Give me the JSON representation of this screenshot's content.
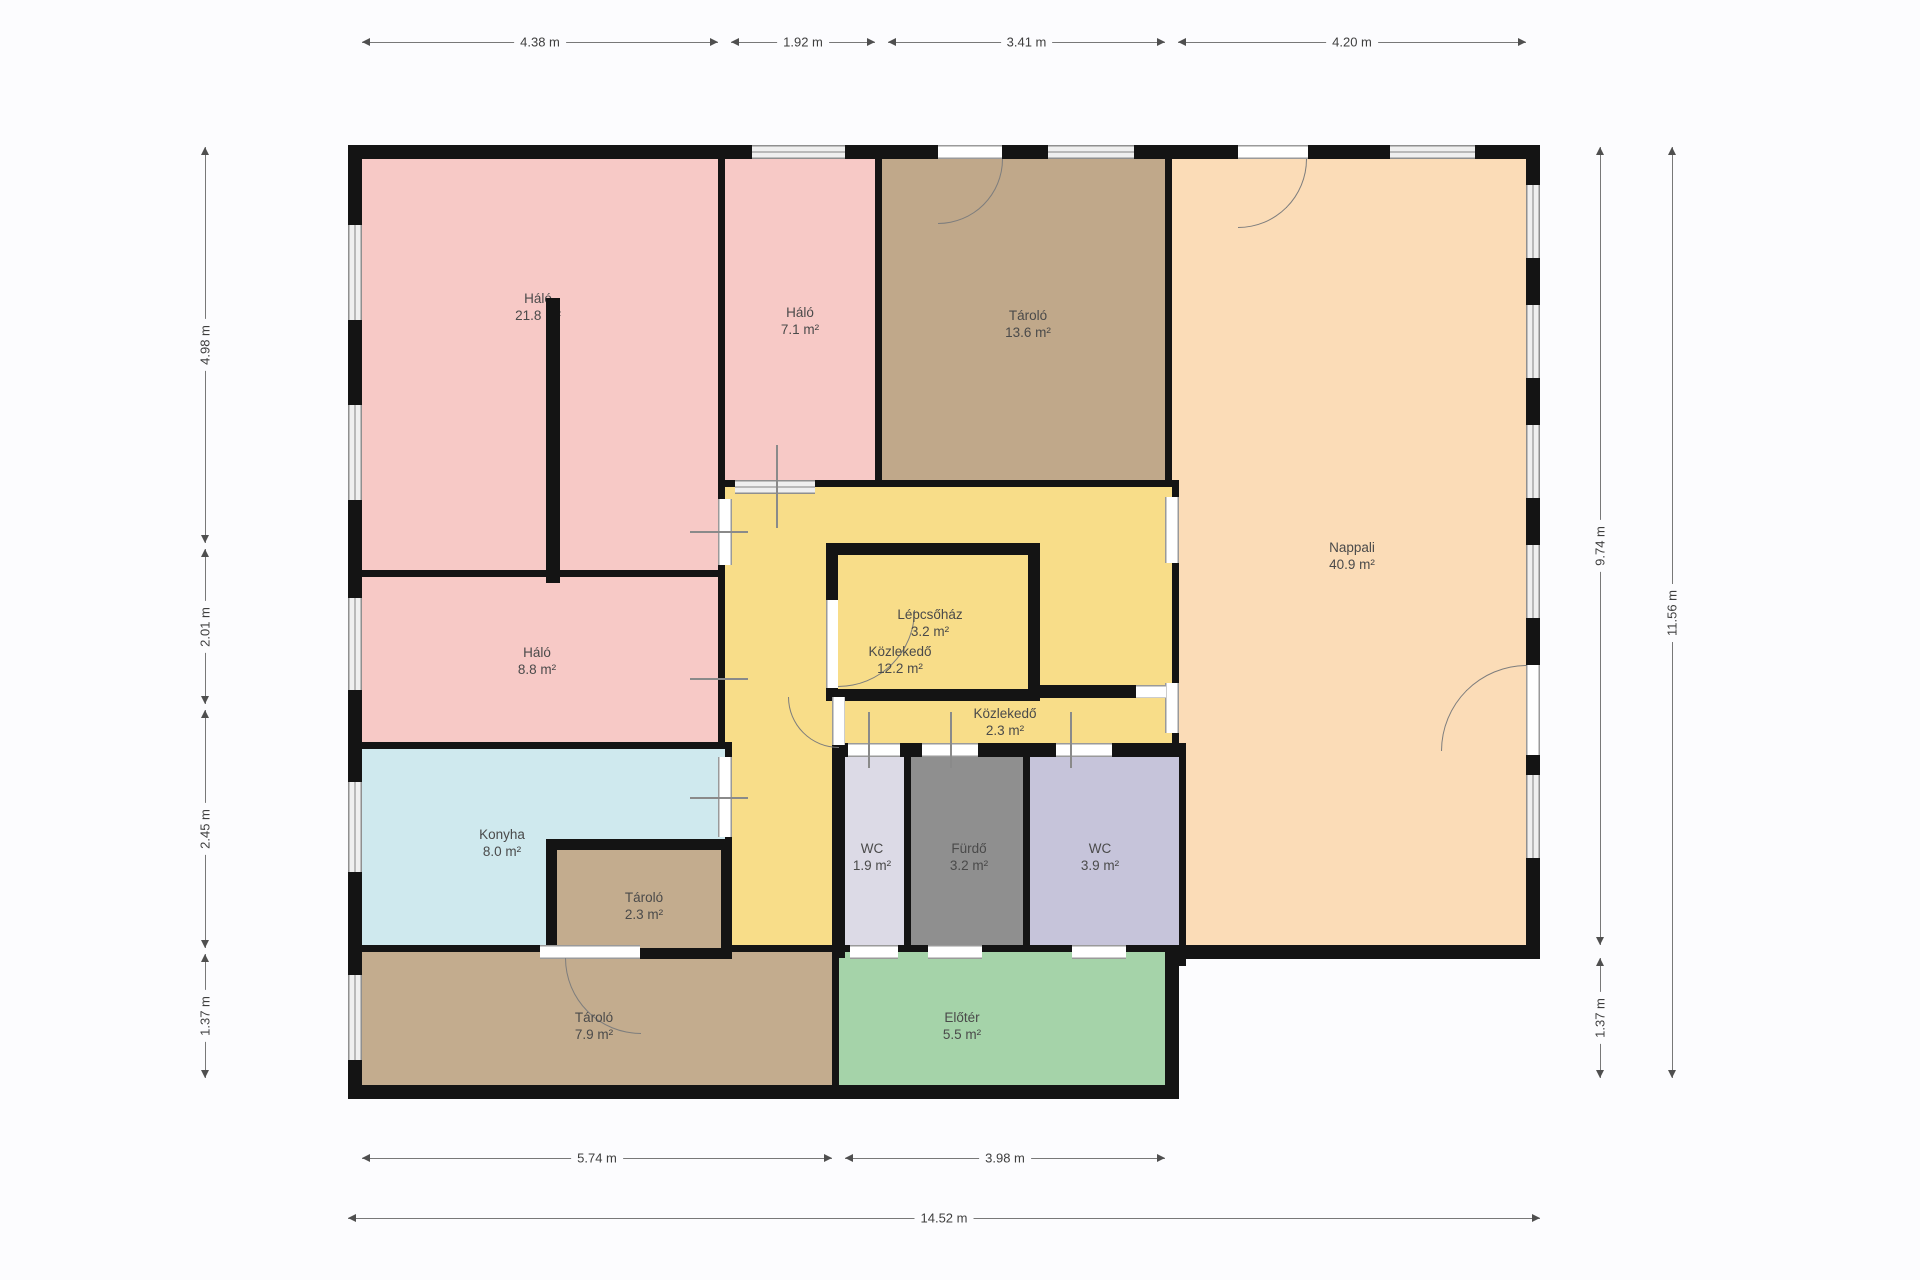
{
  "plan": {
    "title": "Floor plan",
    "unit": "m",
    "colors": {
      "wall": "#141414",
      "background": "#fcfcfe",
      "pink_bedroom": "#f7c9c6",
      "tan_storage": "#c0a88a",
      "peach_living": "#fbdcb7",
      "yellow_circulation": "#f8dd89",
      "blue_kitchen": "#cfe9ee",
      "lavender_wc_small": "#dcdae6",
      "lavender_wc_large": "#c6c4da",
      "gray_bathroom": "#8f8f8f",
      "green_entry": "#a5d3a9",
      "window_fill": "#efefef",
      "dimension_text": "#3e3e3e",
      "room_label_text": "#4a4a4a"
    },
    "rooms": [
      {
        "id": "halo-large",
        "name": "Háló",
        "area": "21.8 m²",
        "color": "#f7c9c6"
      },
      {
        "id": "halo-small",
        "name": "Háló",
        "area": "7.1 m²",
        "color": "#f7c9c6"
      },
      {
        "id": "tarolo-top",
        "name": "Tároló",
        "area": "13.6 m²",
        "color": "#c0a88a"
      },
      {
        "id": "nappali",
        "name": "Nappali",
        "area": "40.9 m²",
        "color": "#fbdcb7"
      },
      {
        "id": "halo-mid",
        "name": "Háló",
        "area": "8.8 m²",
        "color": "#f7c9c6"
      },
      {
        "id": "kozlekedo-main",
        "name": "Közlekedő",
        "area": "12.2 m²",
        "color": "#f8dd89"
      },
      {
        "id": "lepcsohaz",
        "name": "Lépcsőház",
        "area": "3.2 m²",
        "color": "#f8dd89"
      },
      {
        "id": "kozlekedo-small",
        "name": "Közlekedő",
        "area": "2.3 m²",
        "color": "#f8dd89"
      },
      {
        "id": "konyha",
        "name": "Konyha",
        "area": "8.0 m²",
        "color": "#cfe9ee"
      },
      {
        "id": "tarolo-small",
        "name": "Tároló",
        "area": "2.3 m²",
        "color": "#c3ac8e"
      },
      {
        "id": "wc-small",
        "name": "WC",
        "area": "1.9 m²",
        "color": "#dcdae6"
      },
      {
        "id": "furdo",
        "name": "Fürdő",
        "area": "3.2 m²",
        "color": "#8f8f8f"
      },
      {
        "id": "wc-large",
        "name": "WC",
        "area": "3.9 m²",
        "color": "#c6c4da"
      },
      {
        "id": "tarolo-bottom",
        "name": "Tároló",
        "area": "7.9 m²",
        "color": "#c3ac8e"
      },
      {
        "id": "eloter",
        "name": "Előtér",
        "area": "5.5 m²",
        "color": "#a5d3a9"
      }
    ],
    "dims": {
      "top": [
        {
          "label": "4.38 m"
        },
        {
          "label": "1.92 m"
        },
        {
          "label": "3.41 m"
        },
        {
          "label": "4.20 m"
        }
      ],
      "left": [
        {
          "label": "4.98 m"
        },
        {
          "label": "2.01 m"
        },
        {
          "label": "2.45 m"
        },
        {
          "label": "1.37 m"
        }
      ],
      "right": [
        {
          "label": "9.74 m"
        },
        {
          "label": "1.37 m"
        },
        {
          "label": "11.56 m"
        }
      ],
      "bottom": [
        {
          "label": "5.74 m"
        },
        {
          "label": "3.98 m"
        },
        {
          "label": "14.52 m"
        }
      ]
    }
  }
}
